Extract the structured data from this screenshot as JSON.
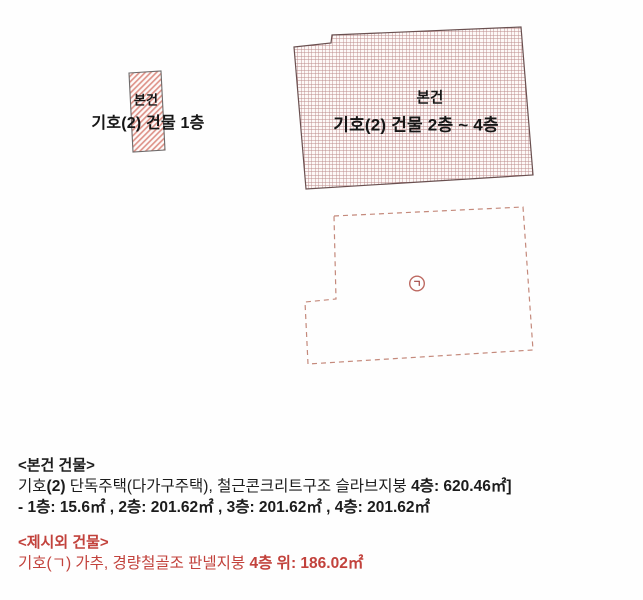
{
  "colors": {
    "hatch_red": "#dd8f85",
    "grid_red": "#bb8a8a",
    "shape_outline": "#6a5050",
    "small_outline": "#6e6a6a",
    "dashed_red": "#c4897b",
    "symbol_red": "#a14440",
    "text_black": "#1c1c1c",
    "text_red": "#c2423c"
  },
  "diagram": {
    "subject_floor1": {
      "tag": "본건",
      "label": "기호(2) 건물 1층"
    },
    "subject_floors2to4": {
      "tag": "본건",
      "label": "기호(2) 건물 2층 ~ 4층"
    },
    "site_outline": {
      "symbol": "ㄱ"
    }
  },
  "notes": {
    "subject": {
      "heading": "<본건 건물>",
      "line1": {
        "seg1": "기호",
        "seg2": "(2)",
        "seg3": " 단독주택(다가구주택), 철근콘크리트구조 슬라브지붕 ",
        "seg4": "4층: 620.46㎡]"
      },
      "line2": "- 1층: 15.6㎡ , 2층: 201.62㎡ , 3층: 201.62㎡ , 4층: 201.62㎡"
    },
    "extra": {
      "heading": "<제시외 건물>",
      "line1": {
        "seg1": "기호(ㄱ) 가추, 경량철골조 판넬지붕 ",
        "seg2": "4층 위: 186.02㎡"
      }
    }
  }
}
